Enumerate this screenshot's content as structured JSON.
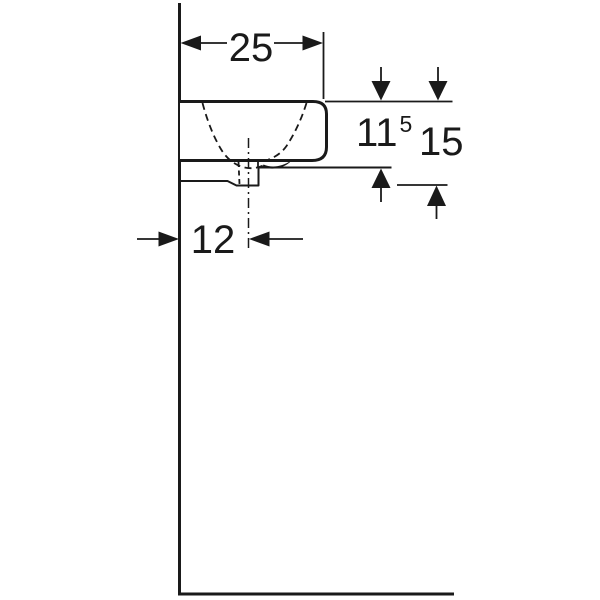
{
  "diagram": {
    "colors": {
      "line_color": "#1a1a1a",
      "background": "#ffffff"
    },
    "dimensions": {
      "width": {
        "value": "25"
      },
      "depth_to_waste": {
        "value": "11",
        "superscript": "5"
      },
      "overall_depth": {
        "value": "15"
      },
      "waste_offset": {
        "value": "12"
      }
    }
  }
}
